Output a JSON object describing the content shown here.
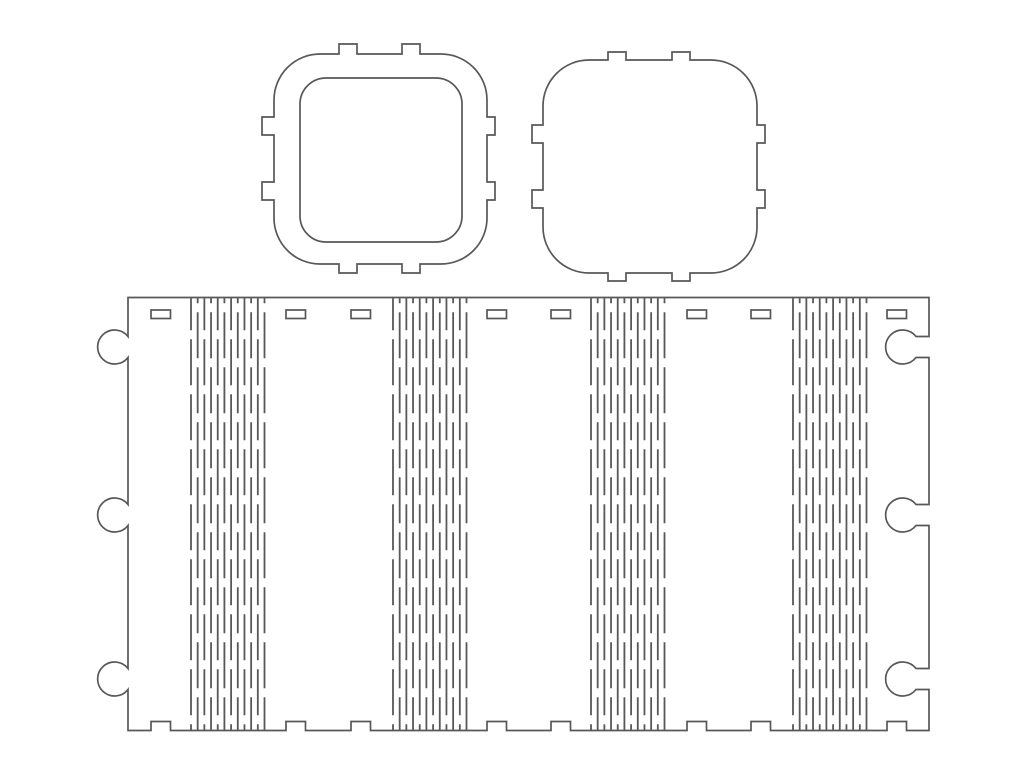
{
  "drawing": {
    "title": "laser-cut-flex-box-template",
    "background": "#ffffff",
    "stroke_color": "#58585a",
    "outline_width": 1.7,
    "hinge_line_width": 1.8,
    "canvas": {
      "width": 1024,
      "height": 768
    },
    "frame_ring": {
      "outer": {
        "x0": 274,
        "y0": 54,
        "x1": 487,
        "y1": 264,
        "radius": 46
      },
      "tab_depths": {
        "top": 10,
        "right": 8,
        "bottom": 9,
        "left": 12
      },
      "tabs": {
        "top": [
          [
            339,
            357
          ],
          [
            402,
            420
          ]
        ],
        "bottom": [
          [
            339,
            357
          ],
          [
            402,
            420
          ]
        ],
        "left": [
          [
            117,
            135
          ],
          [
            182,
            200
          ]
        ],
        "right": [
          [
            117,
            135
          ],
          [
            182,
            200
          ]
        ]
      },
      "hole": {
        "x": 300,
        "y": 78,
        "w": 162,
        "h": 164,
        "radius": 26
      }
    },
    "lid": {
      "outer": {
        "x0": 543,
        "y0": 60,
        "x1": 757,
        "y1": 273,
        "radius": 46
      },
      "tab_depths": {
        "top": 8,
        "right": 8,
        "bottom": 8,
        "left": 11
      },
      "tabs": {
        "top": [
          [
            608,
            626
          ],
          [
            672,
            690
          ]
        ],
        "bottom": [
          [
            608,
            626
          ],
          [
            672,
            690
          ]
        ],
        "left": [
          [
            125,
            143
          ],
          [
            190,
            208
          ]
        ],
        "right": [
          [
            125,
            143
          ],
          [
            190,
            208
          ]
        ]
      }
    },
    "hinge_panel": {
      "rect": {
        "x0": 128,
        "y0": 297.5,
        "x1": 929,
        "y1": 730.5
      },
      "left_knobs": {
        "centers_y": [
          347,
          515,
          679
        ],
        "radius": 17,
        "neck_half": 10.5
      },
      "right_sockets": {
        "centers_y": [
          347,
          515,
          679
        ],
        "radius": 17,
        "neck_half": 10.5,
        "inset": 13
      },
      "top_slots": {
        "x_starts": [
          151,
          286,
          351,
          487,
          551,
          687,
          751,
          887
        ],
        "width": 19.5,
        "y": 310,
        "height": 8.5
      },
      "bottom_notches": {
        "x_starts": [
          151,
          286,
          351,
          487,
          551,
          687,
          751,
          887
        ],
        "width": 19.5,
        "depth": 9
      },
      "hinge_bands": {
        "x_starts": [
          191,
          393,
          591,
          793
        ],
        "band_width": 73.5,
        "line_count": 12,
        "dash": 46,
        "gap": 9,
        "dash_offsets": [
          14,
          41
        ]
      }
    }
  }
}
